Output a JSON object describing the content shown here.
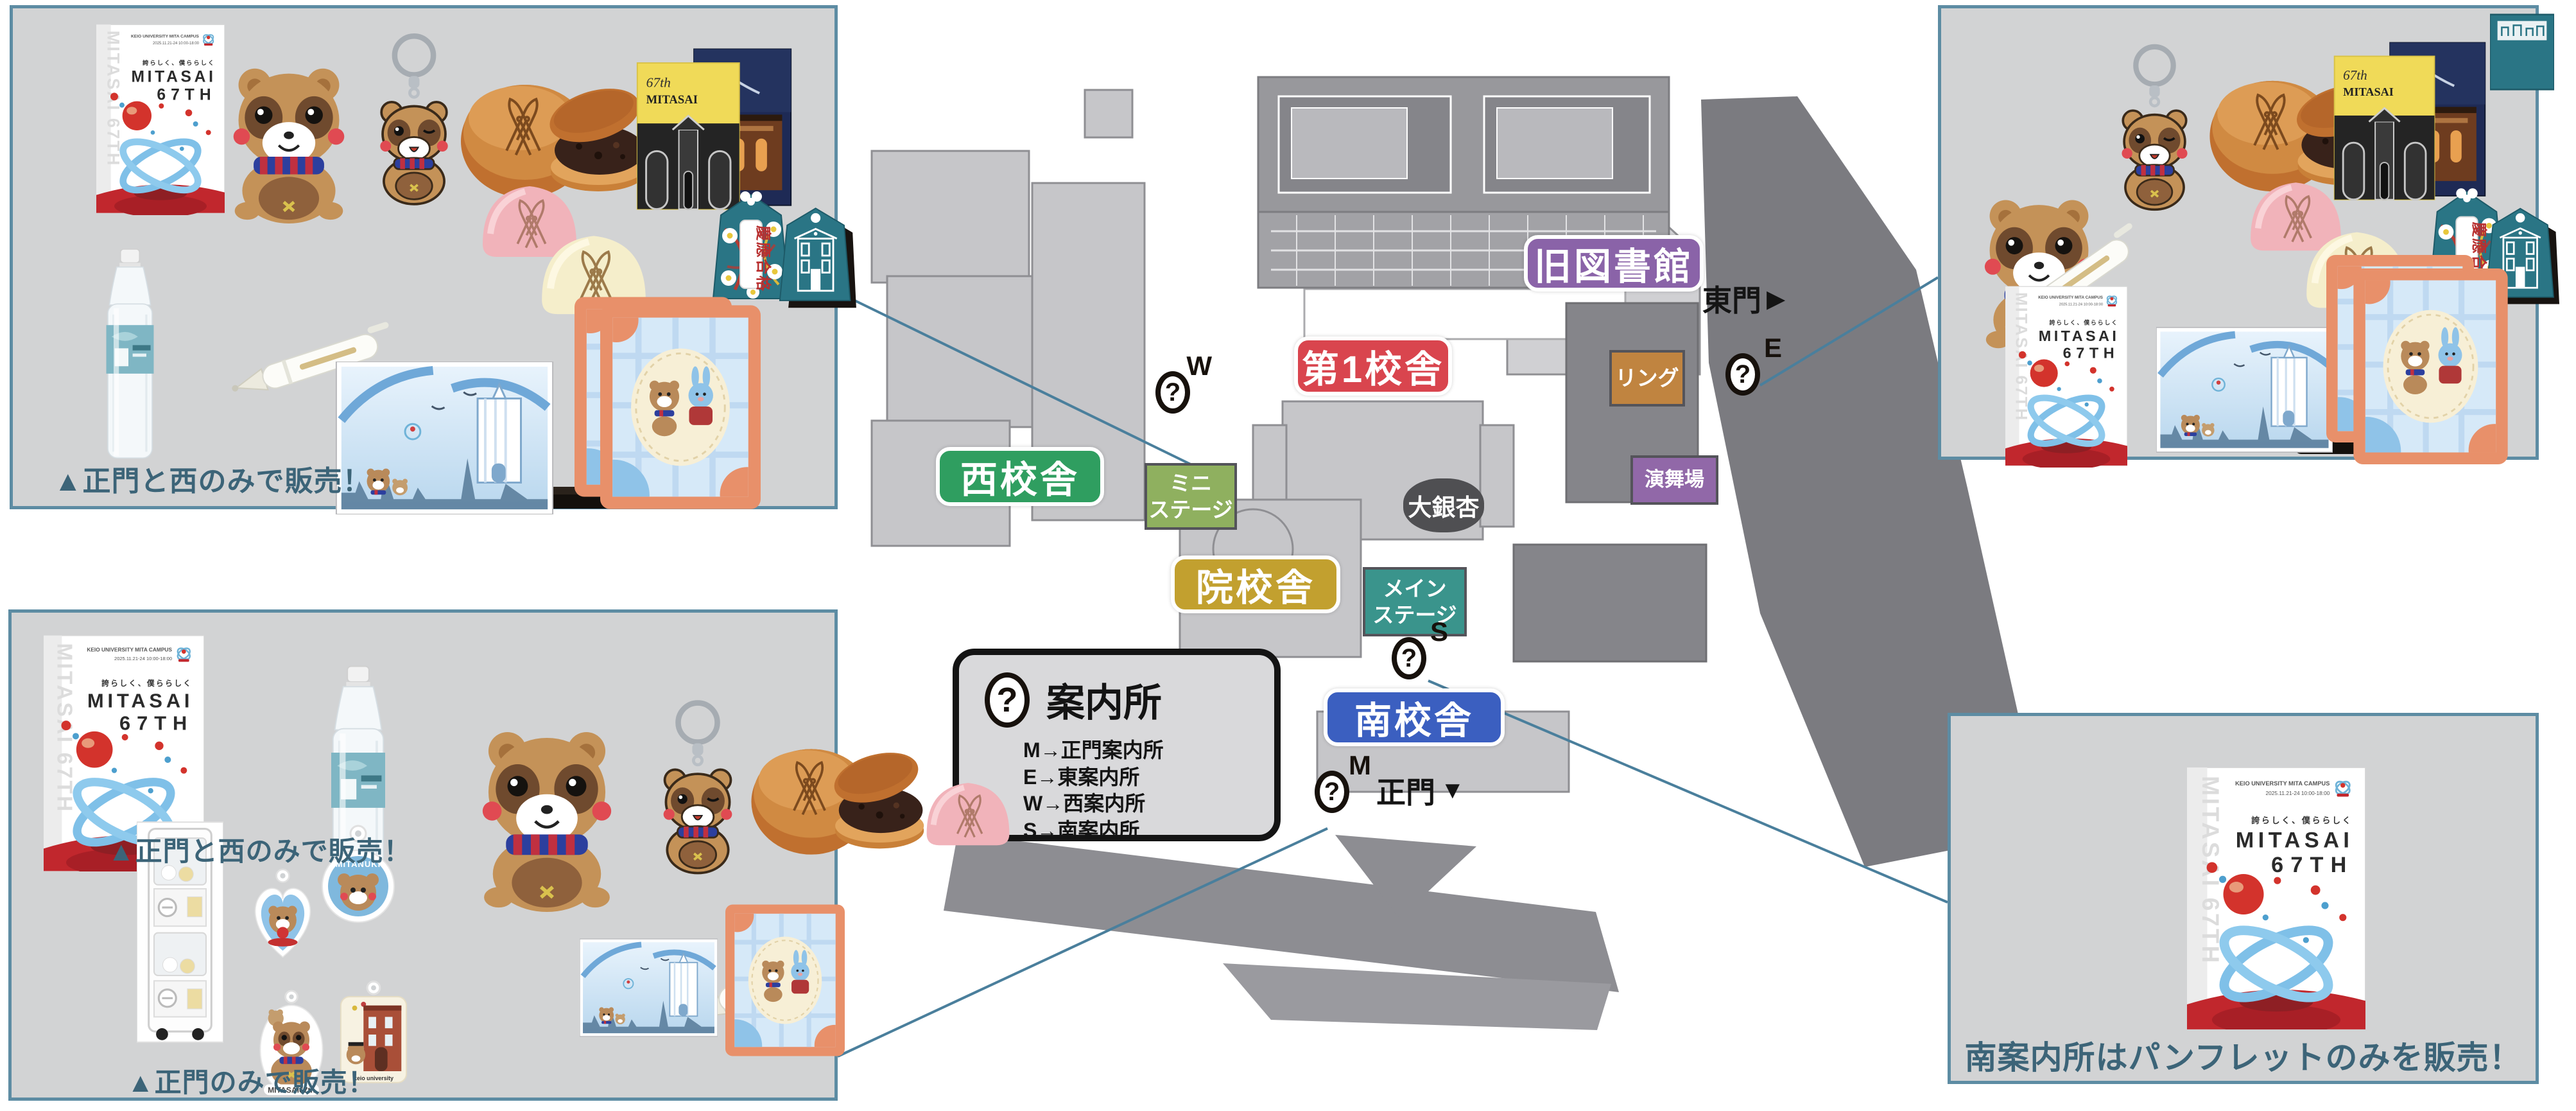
{
  "map": {
    "labels": {
      "old_library": "旧図書館",
      "building_1": "第1校舎",
      "west_building": "西校舎",
      "grad_building": "院校舎",
      "south_building": "南校舎",
      "mini_stage_1": "ミニ",
      "mini_stage_2": "ステージ",
      "main_stage_1": "メイン",
      "main_stage_2": "ステージ",
      "ring": "リング",
      "enbujo": "演舞場",
      "ginkgo": "大銀杏"
    },
    "gates": {
      "east": "東門",
      "east_arrow": "▶",
      "main": "正門",
      "main_arrow": "▼"
    },
    "info_points": {
      "glyph": "?",
      "w": "W",
      "e": "E",
      "s": "S",
      "m": "M"
    },
    "legend": {
      "glyph": "?",
      "title": "案内所",
      "rows": [
        "M→正門案内所",
        "E→東案内所",
        "W→西案内所",
        "S→南案内所"
      ]
    }
  },
  "panels": {
    "top_left": {
      "caption": "▲正門と西のみで販売！"
    },
    "bottom_left": {
      "caption_top": "▲正門と西のみで販売！",
      "caption_bottom": "▲正門のみで販売！"
    },
    "bottom_right": {
      "caption": "南案内所はパンフレットのみを販売！"
    }
  },
  "pamphlet": {
    "org": "KEIO UNIVERSITY MITA CAMPUS",
    "dates": "2025.11.21-24 10:00-18:00",
    "tagline": "誇らしく、僕ららしく",
    "title_line1": "MITASAI",
    "title_line2": "67TH",
    "watermark": "MITASAI 67TH"
  },
  "merch": {
    "card_yellow_line1": "67th",
    "card_yellow_line2": "MITASAI",
    "omamori_text": "慶應合格",
    "charm_round_text": "MITANUKI",
    "charm_bear_text": "MITASAI67th",
    "charm_building_text": "keio university"
  },
  "colors": {
    "old_library": "#8a63a8",
    "building_1": "#d9454e",
    "west_building": "#2f9e60",
    "grad_building": "#c2a02f",
    "south_building": "#3b5fc0",
    "mini_stage": "#8fb05f",
    "main_stage": "#3a948c",
    "ring": "#c08440",
    "enbujo": "#9168a8",
    "ginkgo": "#4f4f52",
    "caption": "#3c6478",
    "panel_border": "#5d8ca3",
    "panel_bg": "#d2d3d4",
    "connector": "#4a7f9c"
  }
}
